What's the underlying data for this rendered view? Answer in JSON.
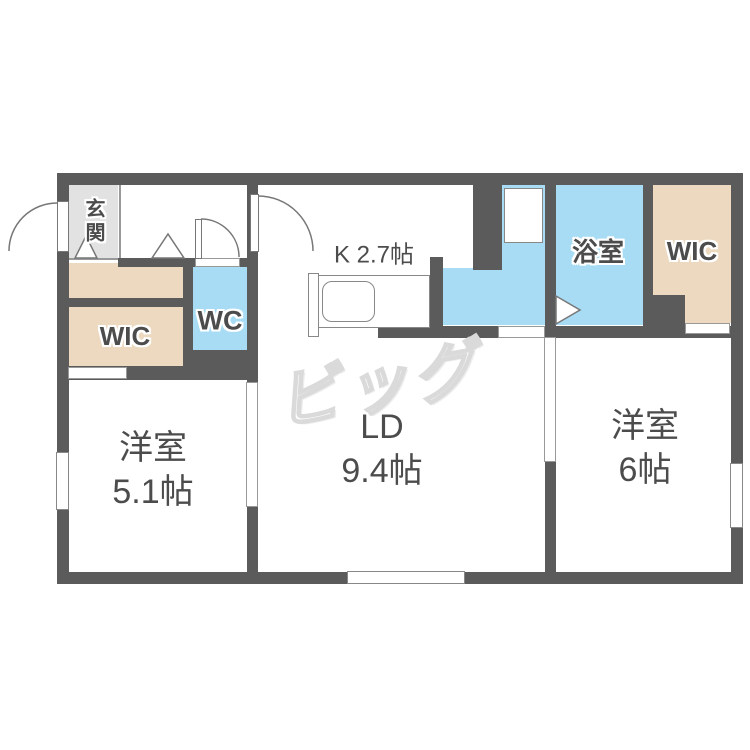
{
  "floorplan": {
    "logo_text": "ビッグ",
    "labels": {
      "genkan": "玄関",
      "wic_left": "WIC",
      "wc": "WC",
      "kitchen": "K 2.7帖",
      "bath": "浴室",
      "wic_right": "WIC",
      "bedroom_left": {
        "name": "洋室",
        "size": "5.1帖"
      },
      "living_dining": {
        "name": "LD",
        "size": "9.4帖"
      },
      "bedroom_right": {
        "name": "洋室",
        "size": "6帖"
      }
    },
    "colors": {
      "wall": "#5b5b5b",
      "closet": "#ecd9bf",
      "water": "#a8dcf4",
      "entry": "#e2e2e2",
      "label": "#4c4c4c",
      "logo": "#dadada"
    }
  }
}
